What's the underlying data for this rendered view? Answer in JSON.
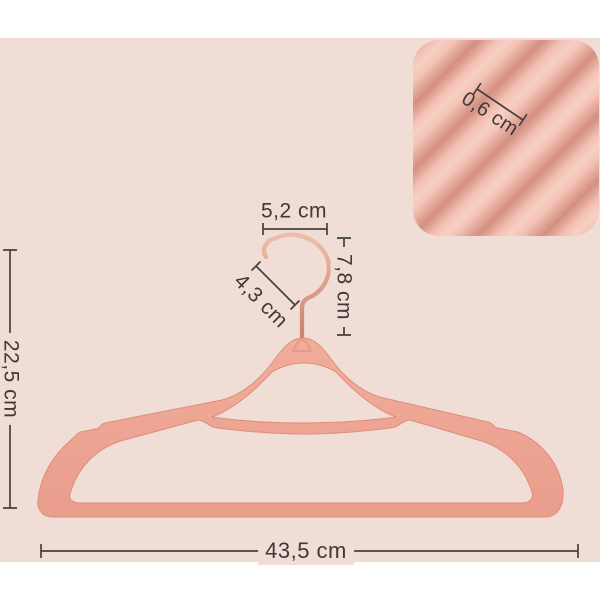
{
  "page": {
    "background": "#ffffff"
  },
  "photo": {
    "background": "#f0ddd6",
    "description": "flat-lay dimension diagram of a velvet non-slip suit hanger with rose-gold swivel hook"
  },
  "inset": {
    "description": "close-up of ribbed velvet surface",
    "velvet_light": "#f6cabd",
    "velvet_dark": "#cf8a7b"
  },
  "hanger": {
    "body_color": "#efa493",
    "edge_color": "#de8d7c",
    "hook_color": "#d39078"
  },
  "labels": {
    "hook_width": "5,2 cm",
    "hook_height": "7,8 cm",
    "hook_opening": "4,3 cm",
    "hanger_height": "22,5 cm",
    "hanger_width": "43,5 cm",
    "velvet_thickness": "0,6 cm"
  },
  "text_color": "#3f3937"
}
